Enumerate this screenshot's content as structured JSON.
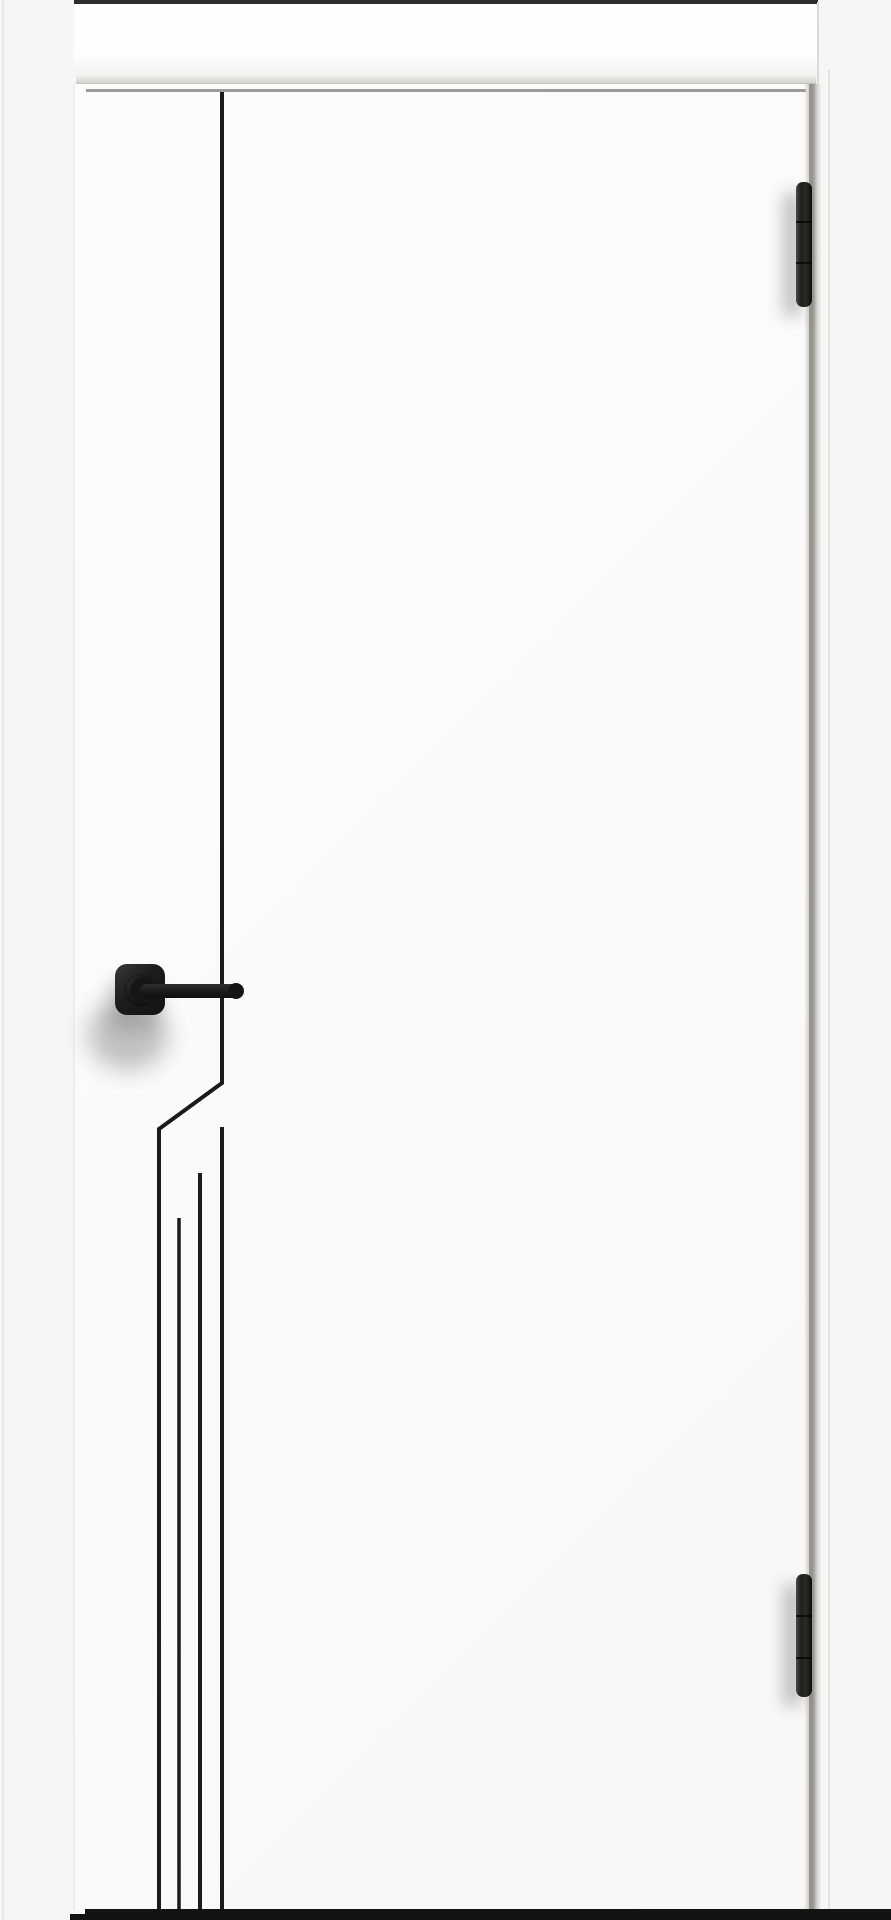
{
  "meta": {
    "content_type": "product photograph",
    "subject": "white interior door leaf with minimalist black line milling, black square-rosette lever handle and two black hinges",
    "orientation": "portrait"
  },
  "colors": {
    "wall": "#f7f6f4",
    "wall_corner_line": "#eae8e5",
    "door": "#fbfaf9",
    "header_board": "#fdfdfc",
    "header_top_strip": "#2e2d2b",
    "gap_line": "#8b8985",
    "design_line": "#1b1b1a",
    "hardware_black": "#1d1d1b",
    "shadow": "#3a3835",
    "bottom_strip": "#131311"
  },
  "design": {
    "pattern": "single vertical groove from door top, jogging diagonally left at handle height, continuing as four staggered vertical grooves to the door bottom",
    "groove_count_bottom": 4
  },
  "hardware": {
    "hinge_count": 2,
    "hinge_knuckle_segments": 3,
    "handle_type": "square-rosette lever, matte black"
  }
}
